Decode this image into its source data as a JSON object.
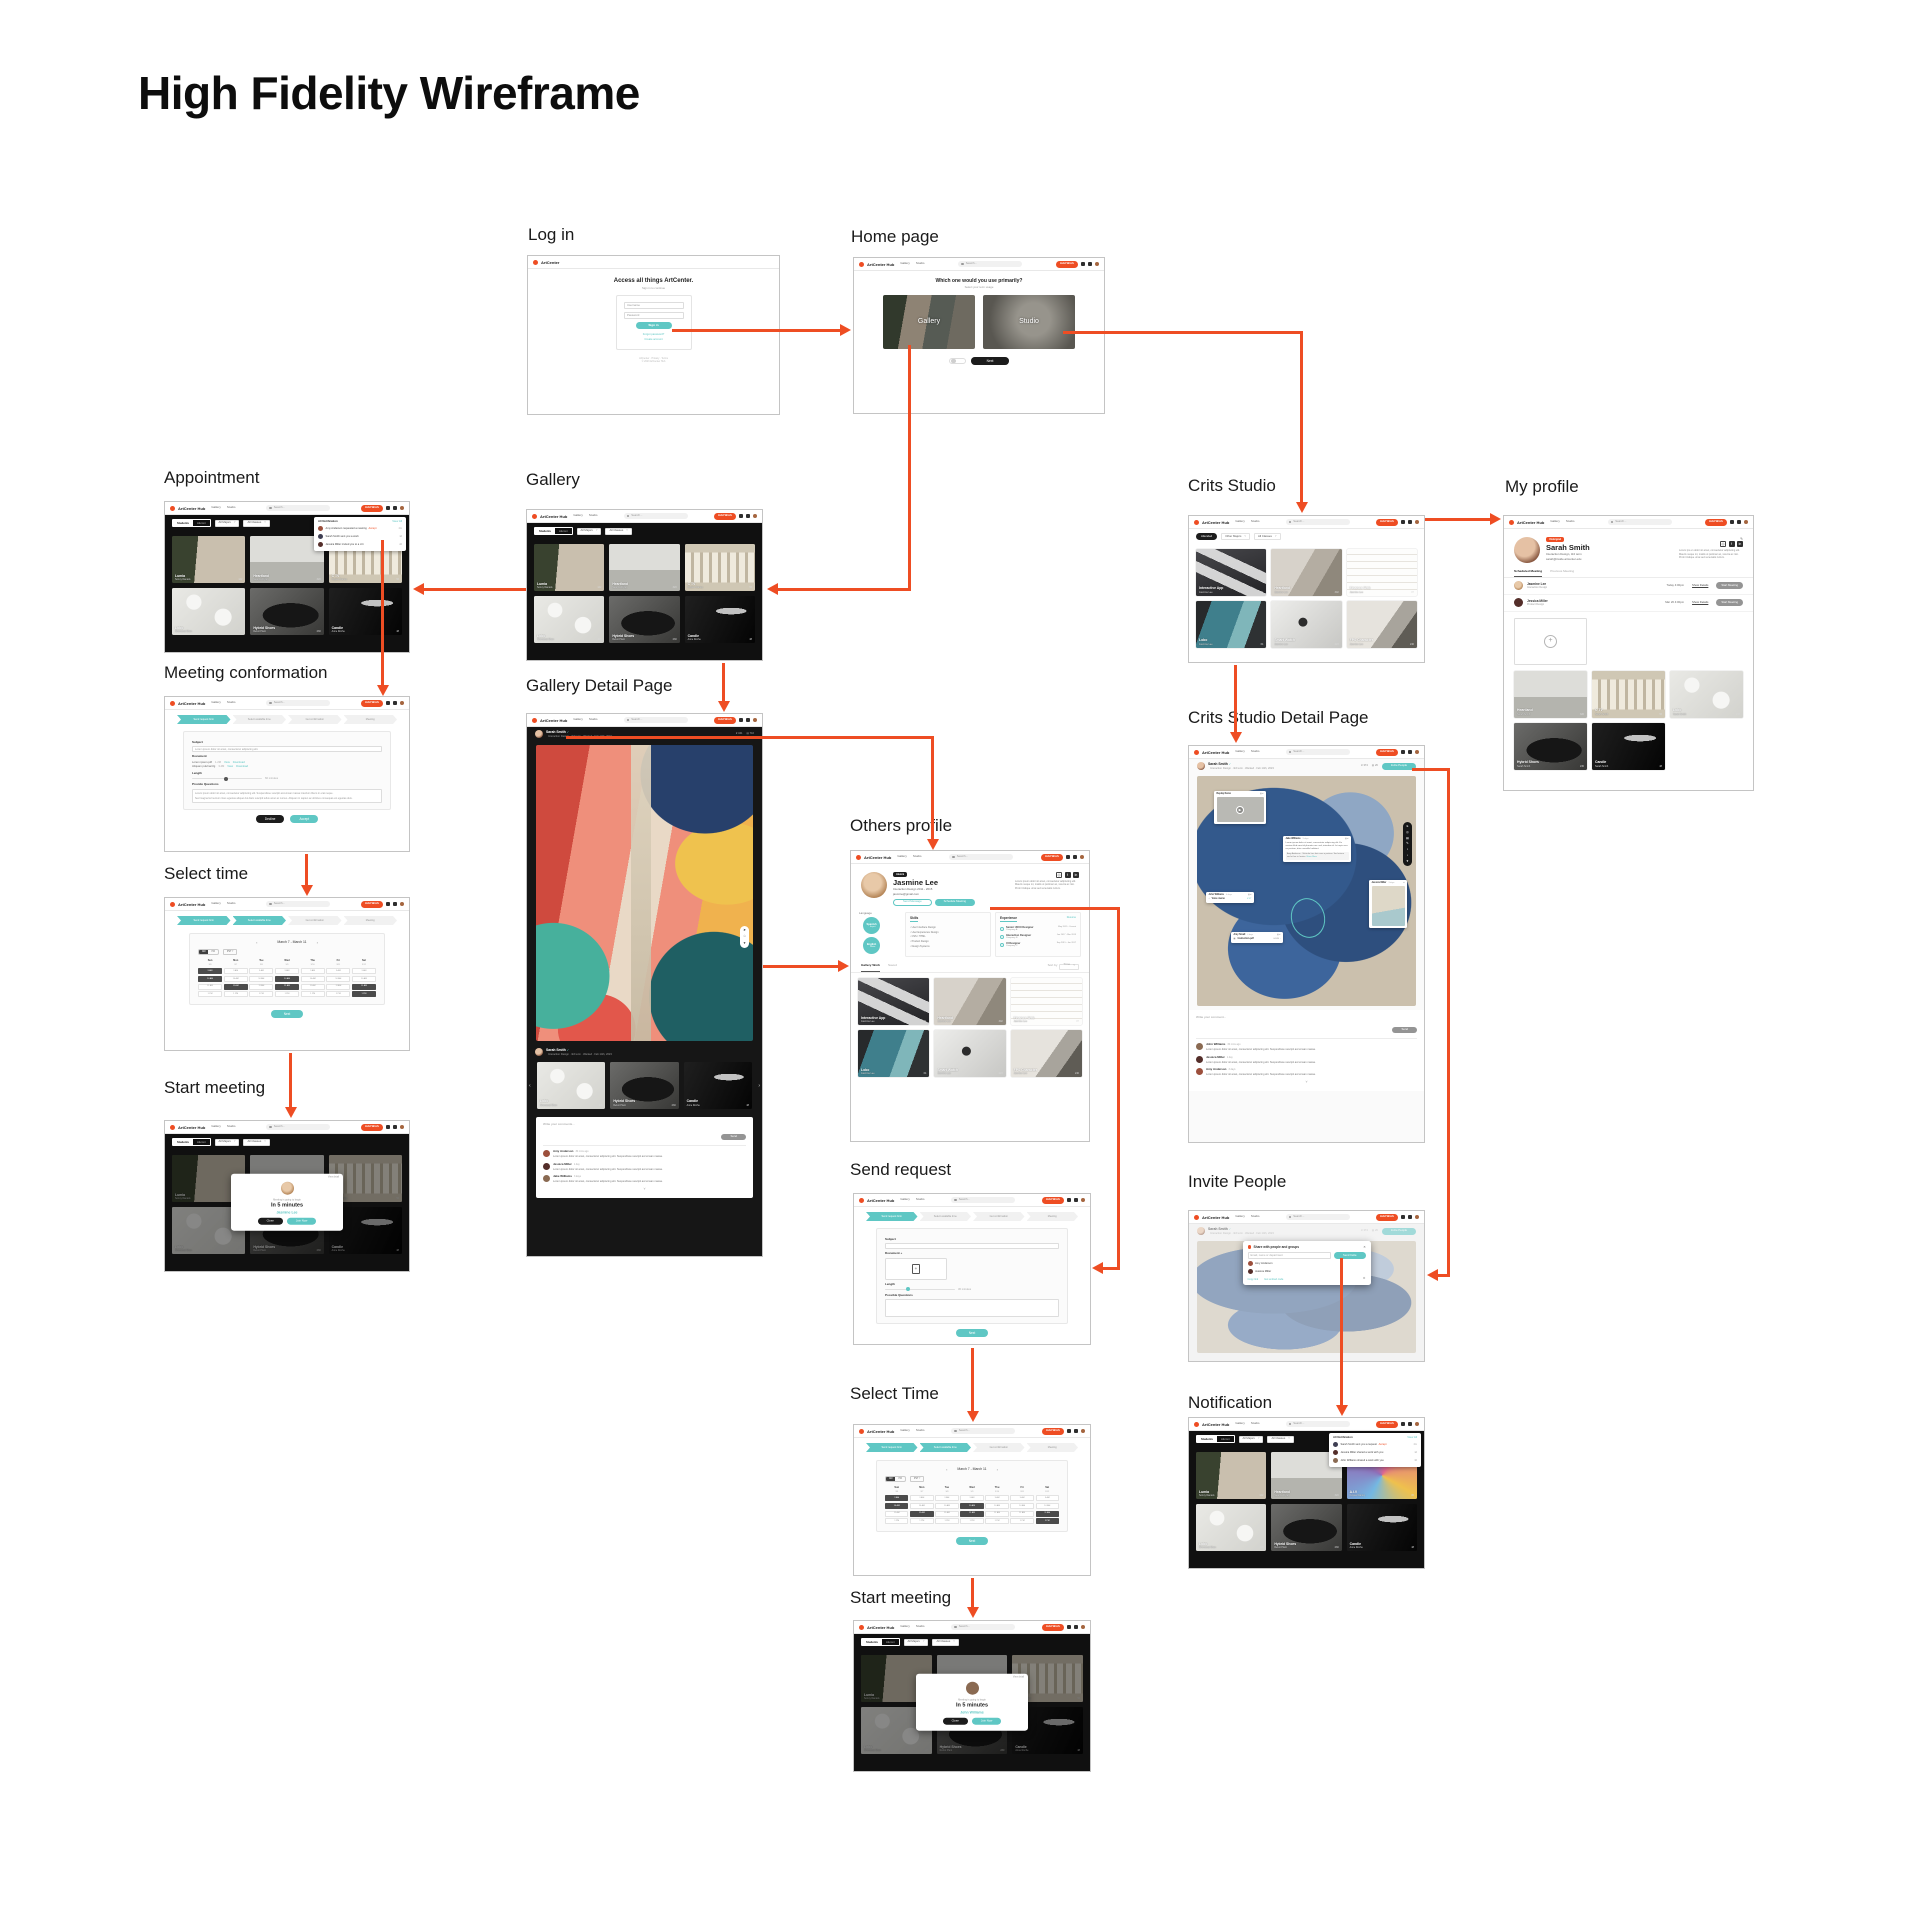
{
  "title": "High Fidelity Wireframe",
  "colors": {
    "accent_orange": "#EE4D23",
    "accent_teal": "#5FC7C4"
  },
  "brand": {
    "logo_login": "ArtCenter",
    "logo": "ArtCenter Hub",
    "nav_gallery": "Gallery",
    "nav_studio": "Studio",
    "search": "Search...",
    "add_work": "Add Work"
  },
  "steps": [
    "Send request form",
    "Select available time",
    "Get confirmation",
    "Meeting"
  ],
  "gallery_cards": [
    {
      "title": "Lumia",
      "author": "Sonny Daniels",
      "likes": "142",
      "art": "lumia"
    },
    {
      "title": "Heartland",
      "author": "Seanna Dylan",
      "likes": "320",
      "art": "heartland"
    },
    {
      "title": "C TV",
      "author": "Kaylee Danley",
      "likes": "56",
      "art": "ctv"
    },
    {
      "title": "Lobo",
      "author": "Sherwood Shen",
      "likes": "105",
      "art": "lobo"
    },
    {
      "title": "Hybrid Shoes",
      "author": "Rebot Plant",
      "likes": "230",
      "art": "shoe"
    },
    {
      "title": "Candle",
      "author": "Anne Roche",
      "likes": "48",
      "art": "candle"
    }
  ],
  "notification_cards": [
    {
      "title": "Lumia",
      "author": "Sonny Daniels",
      "likes": "142",
      "art": "lumia"
    },
    {
      "title": "Heartland",
      "author": "Seanna Dylan",
      "likes": "320",
      "art": "heartland"
    },
    {
      "title": "A.I.V",
      "author": "Kaylee Danley",
      "likes": "86",
      "art": "pattern"
    },
    {
      "title": "Lobo",
      "author": "Sherwood Shen",
      "likes": "105",
      "art": "lobo"
    },
    {
      "title": "Hybrid Shoes",
      "author": "Rebot Plant",
      "likes": "230",
      "art": "shoe"
    },
    {
      "title": "Candle",
      "author": "Anne Roche",
      "likes": "48",
      "art": "candle"
    }
  ],
  "studio_cards": [
    {
      "title": "Interactive App",
      "author": "Jasmine Lee",
      "likes": "41",
      "art": "app"
    },
    {
      "title": "Heartland",
      "author": "Jasmine Lee",
      "likes": "302",
      "art": "draw"
    },
    {
      "title": "Finance Web",
      "author": "Jasmine Lee",
      "likes": "87",
      "art": "wire"
    },
    {
      "title": "Lobo",
      "author": "Jasmine Lee",
      "likes": "64",
      "art": "tablet"
    },
    {
      "title": "Smart Watch",
      "author": "Jasmine Lee",
      "likes": "223",
      "art": "watch"
    },
    {
      "title": "FPS Character",
      "author": "Jasmine Lee",
      "likes": "240",
      "art": "fps"
    }
  ],
  "profile_cards": [
    {
      "title": "Heartland",
      "author": "Sarah Smith",
      "likes": "320",
      "art": "heartland"
    },
    {
      "title": "C TV",
      "author": "Sarah Smith",
      "likes": "56",
      "art": "ctv"
    },
    {
      "title": "Lobo",
      "author": "Sarah Smith",
      "likes": "105",
      "art": "lobo"
    },
    {
      "title": "Hybrid Shoes",
      "author": "Sarah Smith",
      "likes": "230",
      "art": "shoe"
    },
    {
      "title": "Candle",
      "author": "Sarah Smith",
      "likes": "48",
      "art": "candle"
    }
  ],
  "related_cards": [
    {
      "title": "Lobo",
      "author": "Sherwood Shen",
      "likes": "105",
      "art": "lobo"
    },
    {
      "title": "Hybrid Shoes",
      "author": "Rebot Plant",
      "likes": "230",
      "art": "shoe"
    },
    {
      "title": "Candle",
      "author": "Anne Roche",
      "likes": "48",
      "art": "candle"
    }
  ],
  "filters": {
    "toggle_on": "Students",
    "toggle_off": "Alumni",
    "majors": "All Majors",
    "classes": "All Classes",
    "attended": "Attended",
    "other_majors": "Other Majors"
  },
  "screens": {
    "login": {
      "label": "Log in",
      "heading": "Access all things ArtCenter.",
      "sub": "Sign in to continue",
      "username": "Username",
      "password": "Password",
      "signin": "Sign in",
      "forgot": "Forgot password?",
      "create": "Create account",
      "fine1": "ArtCenter · Privacy · Terms",
      "fine2": "© 2023 ArtCenter Hub"
    },
    "home": {
      "label": "Home page",
      "question": "Which one would you use primarily?",
      "sub": "Select your term usage",
      "cards": [
        "Gallery",
        "Studio"
      ],
      "next": "Next"
    },
    "appointment": {
      "label": "Appointment"
    },
    "gallery": {
      "label": "Gallery"
    },
    "crits_studio": {
      "label": "Crits Studio"
    },
    "my_profile": {
      "label": "My profile",
      "badge": "Undergrad",
      "name": "Sarah Smith",
      "meta": "Interaction Design, 3rd term",
      "email": "sarah@inside.artcenter.edu",
      "bio": "Lorem ips en dolor sit amet, consectetur adipiscing elit. Mauris neque mi, mattis ut pulvinar ac, viverra ac nisi. Proin tristique urna sed venenatis rutrum.",
      "tab1": "Scheduled Meeting",
      "tab2": "Previous Meeting"
    },
    "meeting_conf": {
      "label": "Meeting conformation",
      "subject_label": "Subject",
      "subject": "Lorem ipsum dolor sit amet, consectetur adipiscing elit.",
      "document_label": "Document",
      "length_label": "Length",
      "length_value": "60 minutes",
      "questions_label": "Provide Questions",
      "questions1": "Lorem ipsum dolor sit amet, consectetur adipiscing elit. Suspendisse suscipit accumsan massa interdum libero in erat neque.",
      "questions2": "Sed magna fermentum risus egestas aliquet dui diam suscipit tellus amet ac cursus. Aliquam in sapien ac ultricies consequat est egestas duis.",
      "decline": "Decline",
      "accept": "Accept"
    },
    "gallery_detail": {
      "label": "Gallery Detail Page",
      "author": "Sarah Smith",
      "meta": "Interaction Design · 3rd term · Wanted · Feb 14th, 2023",
      "likes": "341",
      "views": "716",
      "placeholder": "Write your comments...",
      "send": "Send"
    },
    "others_profile": {
      "label": "Others profile",
      "badge": "Alumni",
      "name": "Jasmine Lee",
      "meta": "Interaction Design   2011 - 2015",
      "email": "jasmine@gmail.com",
      "btn_message": "Send Message",
      "btn_schedule": "Schedule Meeting",
      "bio": "Lorem ipsum dolor sit amet, consectetur adipiscing elit. Mauris neque mi, mattis ut pulvinar ac, viverra ac nisi. Proin tristique urna sed venenatis rutrum.",
      "language_label": "Language",
      "skills_label": "Skills",
      "exp_label": "Experience",
      "resume": "Resume",
      "tab1": "Gallery Work",
      "tab2": "Saved",
      "sort": "Sort by",
      "sort_value": "Time"
    },
    "send_request": {
      "label": "Send request",
      "subject_label": "Subject",
      "document_label": "Document +",
      "length_label": "Length",
      "length_value": "30 minutes",
      "questions_label": "Possible Questions",
      "next": "Next"
    },
    "select_time": {
      "label": "Select time",
      "label2": "Select Time",
      "week": "March 7 - March 11",
      "am": "AM",
      "pm": "PM",
      "tz": "PST",
      "next": "Next"
    },
    "start_meeting": {
      "label": "Start meeting",
      "pre": "Meeting is going to begin",
      "big": "In 5 minutes",
      "name1": "Jasmine Lee",
      "name2": "John Williams",
      "view": "View detail",
      "close": "Close",
      "join": "Join Now"
    },
    "csdp": {
      "label": "Crits Studio Detail Page",
      "author": "Sarah Smith",
      "meta": "Interaction Design · 3rd term · Wanted · Feb 14th, 2023",
      "likes": "374",
      "views": "26",
      "invite": "Invite People",
      "placeholder": "Write your comment...",
      "send": "Send",
      "video_title": "Replay Demo",
      "voice_label": "Voice memo",
      "voice_dur": "4'32''",
      "file_name": "Instruction.pdf",
      "file_size": "64 KB"
    },
    "invite": {
      "label": "Invite People",
      "header": "Share with people and groups",
      "placeholder": "Email, name or department",
      "send": "Send Invite",
      "copy": "Copy link",
      "embed": "Get embed code"
    },
    "notification": {
      "label": "Notification"
    }
  },
  "meetings": [
    {
      "name": "Jasmine Lee",
      "role": "Interaction Design",
      "time": "Today 4:00pm",
      "details": "Show Details",
      "action": "Start Meeting",
      "av": "jas"
    },
    {
      "name": "Jessica Miller",
      "role": "Product Design",
      "time": "Mar 26 4:00pm",
      "details": "Show Details",
      "action": "Start Meeting",
      "av": "av2"
    }
  ],
  "languages": [
    {
      "name": "Spanish",
      "level": "Expert"
    },
    {
      "name": "English",
      "level": "Native"
    }
  ],
  "skills": [
    "User Interface Design",
    "User Experience Design",
    "CSS / HTML",
    "Product Design",
    "Design Systems"
  ],
  "experience": [
    {
      "role": "Senior UI/UX Designer",
      "company": "Company A",
      "dates": "May 2019 - Current"
    },
    {
      "role": "Interaction Designer",
      "company": "Company B",
      "dates": "Jan 2017 - Mar 2019"
    },
    {
      "role": "UI Designer",
      "company": "Company C",
      "dates": "Sep 2015 - Jan 2017"
    }
  ],
  "conf_files": [
    {
      "name": "Lorem ipsum.pdf",
      "size": "1.2M",
      "view": "View",
      "download": "Download"
    },
    {
      "name": "Aliquam pulvinar.fig",
      "size": "3.4M",
      "view": "View",
      "download": "Download"
    }
  ],
  "gdp_comments": [
    {
      "name": "Amy Anderson",
      "time": "30 mins ago",
      "text": "Lorem ipsum dolor sit amet, consectetur adipiscing elit. Suspendisse suscipit accumsan massa.",
      "av": "av1"
    },
    {
      "name": "Jessica Miller",
      "time": "1 day",
      "text": "Lorem ipsum dolor sit amet, consectetur adipiscing elit. Suspendisse suscipit accumsan massa.",
      "av": "av2"
    },
    {
      "name": "Jake Williams",
      "time": "3 days",
      "text": "Lorem ipsum dolor sit amet, consectetur adipiscing elit. Suspendisse suscipit accumsan massa.",
      "av": "av3"
    }
  ],
  "csdp_comments": [
    {
      "name": "John Williams",
      "time": "30 mins ago",
      "text": "Lorem ipsum dolor sit amet, consectetur adipiscing elit. Suspendisse suscipit accumsan massa.",
      "av": "av3"
    },
    {
      "name": "Jessica Miller",
      "time": "1 day",
      "text": "Lorem ipsum dolor sit amet, consectetur adipiscing elit. Suspendisse suscipit accumsan massa.",
      "av": "av2"
    },
    {
      "name": "Amy Anderson",
      "time": "3 days",
      "text": "Lorem ipsum dolor sit amet, consectetur adipiscing elit. Suspendisse suscipit accumsan massa.",
      "av": "av1"
    }
  ],
  "csdp_note": {
    "name": "Jake Williams",
    "time": "3 days",
    "text": "Lorem ipsum dolor sit amet, consectetur adipiscing elit. Ex veniam illud amet id pharetra nec sed, interdum id. In turpis arcu eu pretium, duis convallis habitant.",
    "reply": "Amy Anderson · Vehicula hac duis urna a pretium. Sed rutrum sed ut hac in lacinia.",
    "more": "Show More"
  },
  "csdp_voice": {
    "name": "John Williams",
    "time": "4 days"
  },
  "csdp_file": {
    "name": "Amy Small",
    "time": "4 days"
  },
  "csdp_img": {
    "name": "Jessica Miller",
    "time": "3 days"
  },
  "appointment_notifs": [
    {
      "text": "Amy Anderson requested a meeting",
      "accent": "Accept",
      "time": "2m",
      "av": "av1"
    },
    {
      "text": "Sarah Smith sent you a work",
      "accent": "",
      "time": "1d",
      "av": "av4"
    },
    {
      "text": "Jessica Miller invited you to a crit",
      "accent": "",
      "time": "2d",
      "av": "av2"
    }
  ],
  "notification_notifs": [
    {
      "text": "Sarah Smith sent you a request",
      "accent": "Accept",
      "time": "2m",
      "av": "av4"
    },
    {
      "text": "Jessica Miller shared a work with you",
      "accent": "",
      "time": "1d",
      "av": "av2"
    },
    {
      "text": "John Williams shared a work with you",
      "accent": "",
      "time": "3d",
      "av": "av3"
    }
  ],
  "notif_header": {
    "title": "All Notification",
    "view": "View All"
  },
  "invite_people": [
    {
      "name": "Amy Anderson",
      "av": "av1"
    },
    {
      "name": "Jessica Miller",
      "av": "av2"
    }
  ],
  "days": [
    {
      "d": "Sun",
      "n": "3/6"
    },
    {
      "d": "Mon",
      "n": "3/7"
    },
    {
      "d": "Tue",
      "n": "3/8"
    },
    {
      "d": "Wed",
      "n": "3/9"
    },
    {
      "d": "Thu",
      "n": "3/10"
    },
    {
      "d": "Fri",
      "n": "3/11"
    },
    {
      "d": "Sat",
      "n": "3/12"
    }
  ],
  "slot_cells": [
    "9 AM",
    "9 AM",
    "9 AM",
    "9 AM",
    "9 AM",
    "9 AM",
    "9 AM",
    "10 AM",
    "10 AM",
    "10 AM",
    "10 AM",
    "10 AM",
    "10 AM",
    "10 AM",
    "11 AM",
    "11 AM",
    "11 AM",
    "11 AM",
    "11 AM",
    "11 AM",
    "11 AM",
    "1 PM",
    "1 PM",
    "1 PM",
    "1 PM",
    "1 PM",
    "1 PM",
    "1 PM"
  ]
}
